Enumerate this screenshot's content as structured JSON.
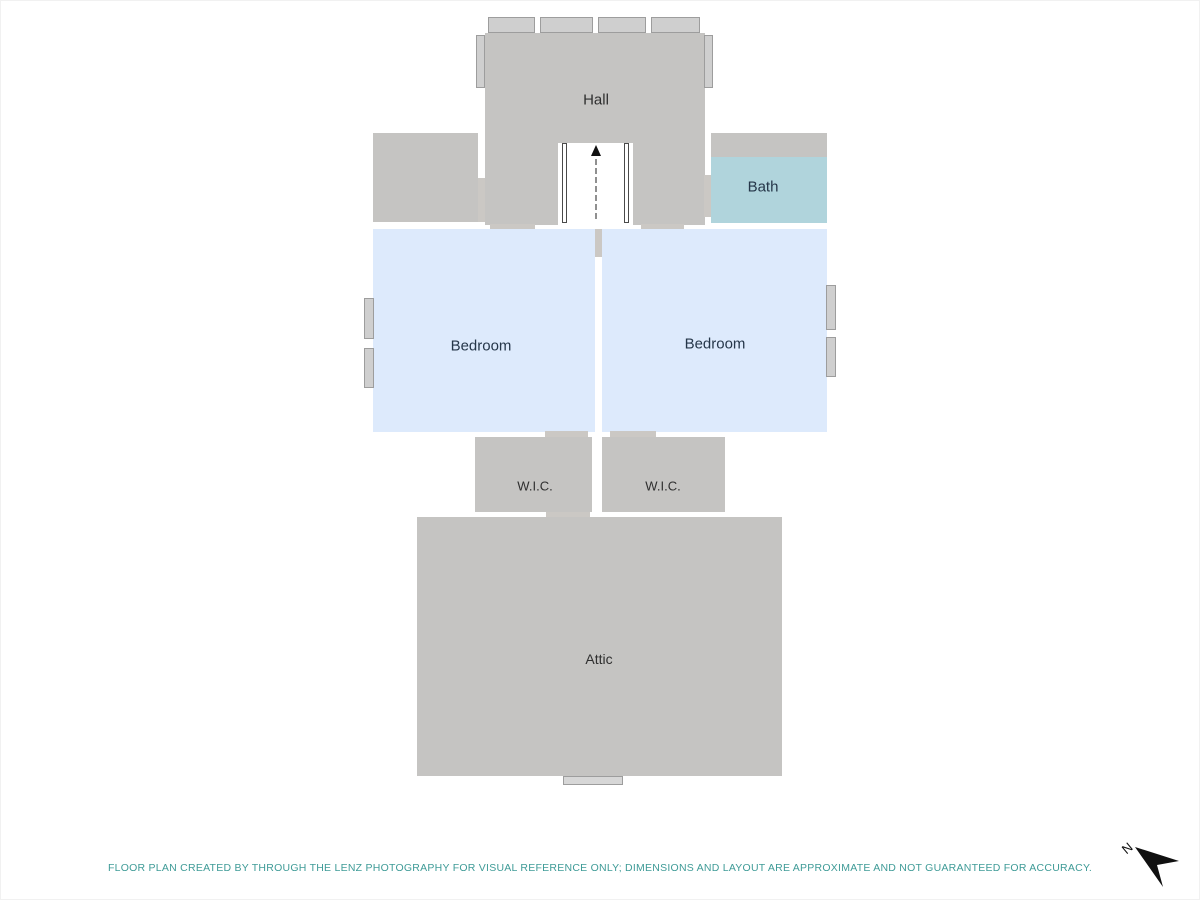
{
  "plan": {
    "rooms": {
      "hall": "Hall",
      "bath": "Bath",
      "bedroom_left": "Bedroom",
      "bedroom_right": "Bedroom",
      "wic_left": "W.I.C.",
      "wic_right": "W.I.C.",
      "attic": "Attic"
    },
    "compass_letter": "N"
  },
  "footer": {
    "disclaimer": "FLOOR PLAN CREATED BY THROUGH THE LENZ PHOTOGRAPHY FOR VISUAL REFERENCE ONLY; DIMENSIONS AND LAYOUT ARE APPROXIMATE AND NOT GUARANTEED FOR ACCURACY."
  },
  "colors": {
    "room_gray": "#c5c4c2",
    "bedroom_blue": "#ddeafc",
    "bath_teal": "#b0d4dc",
    "label_dark": "#2f2f2f",
    "label_navy": "#253649",
    "footer_teal": "#3f9b97"
  }
}
